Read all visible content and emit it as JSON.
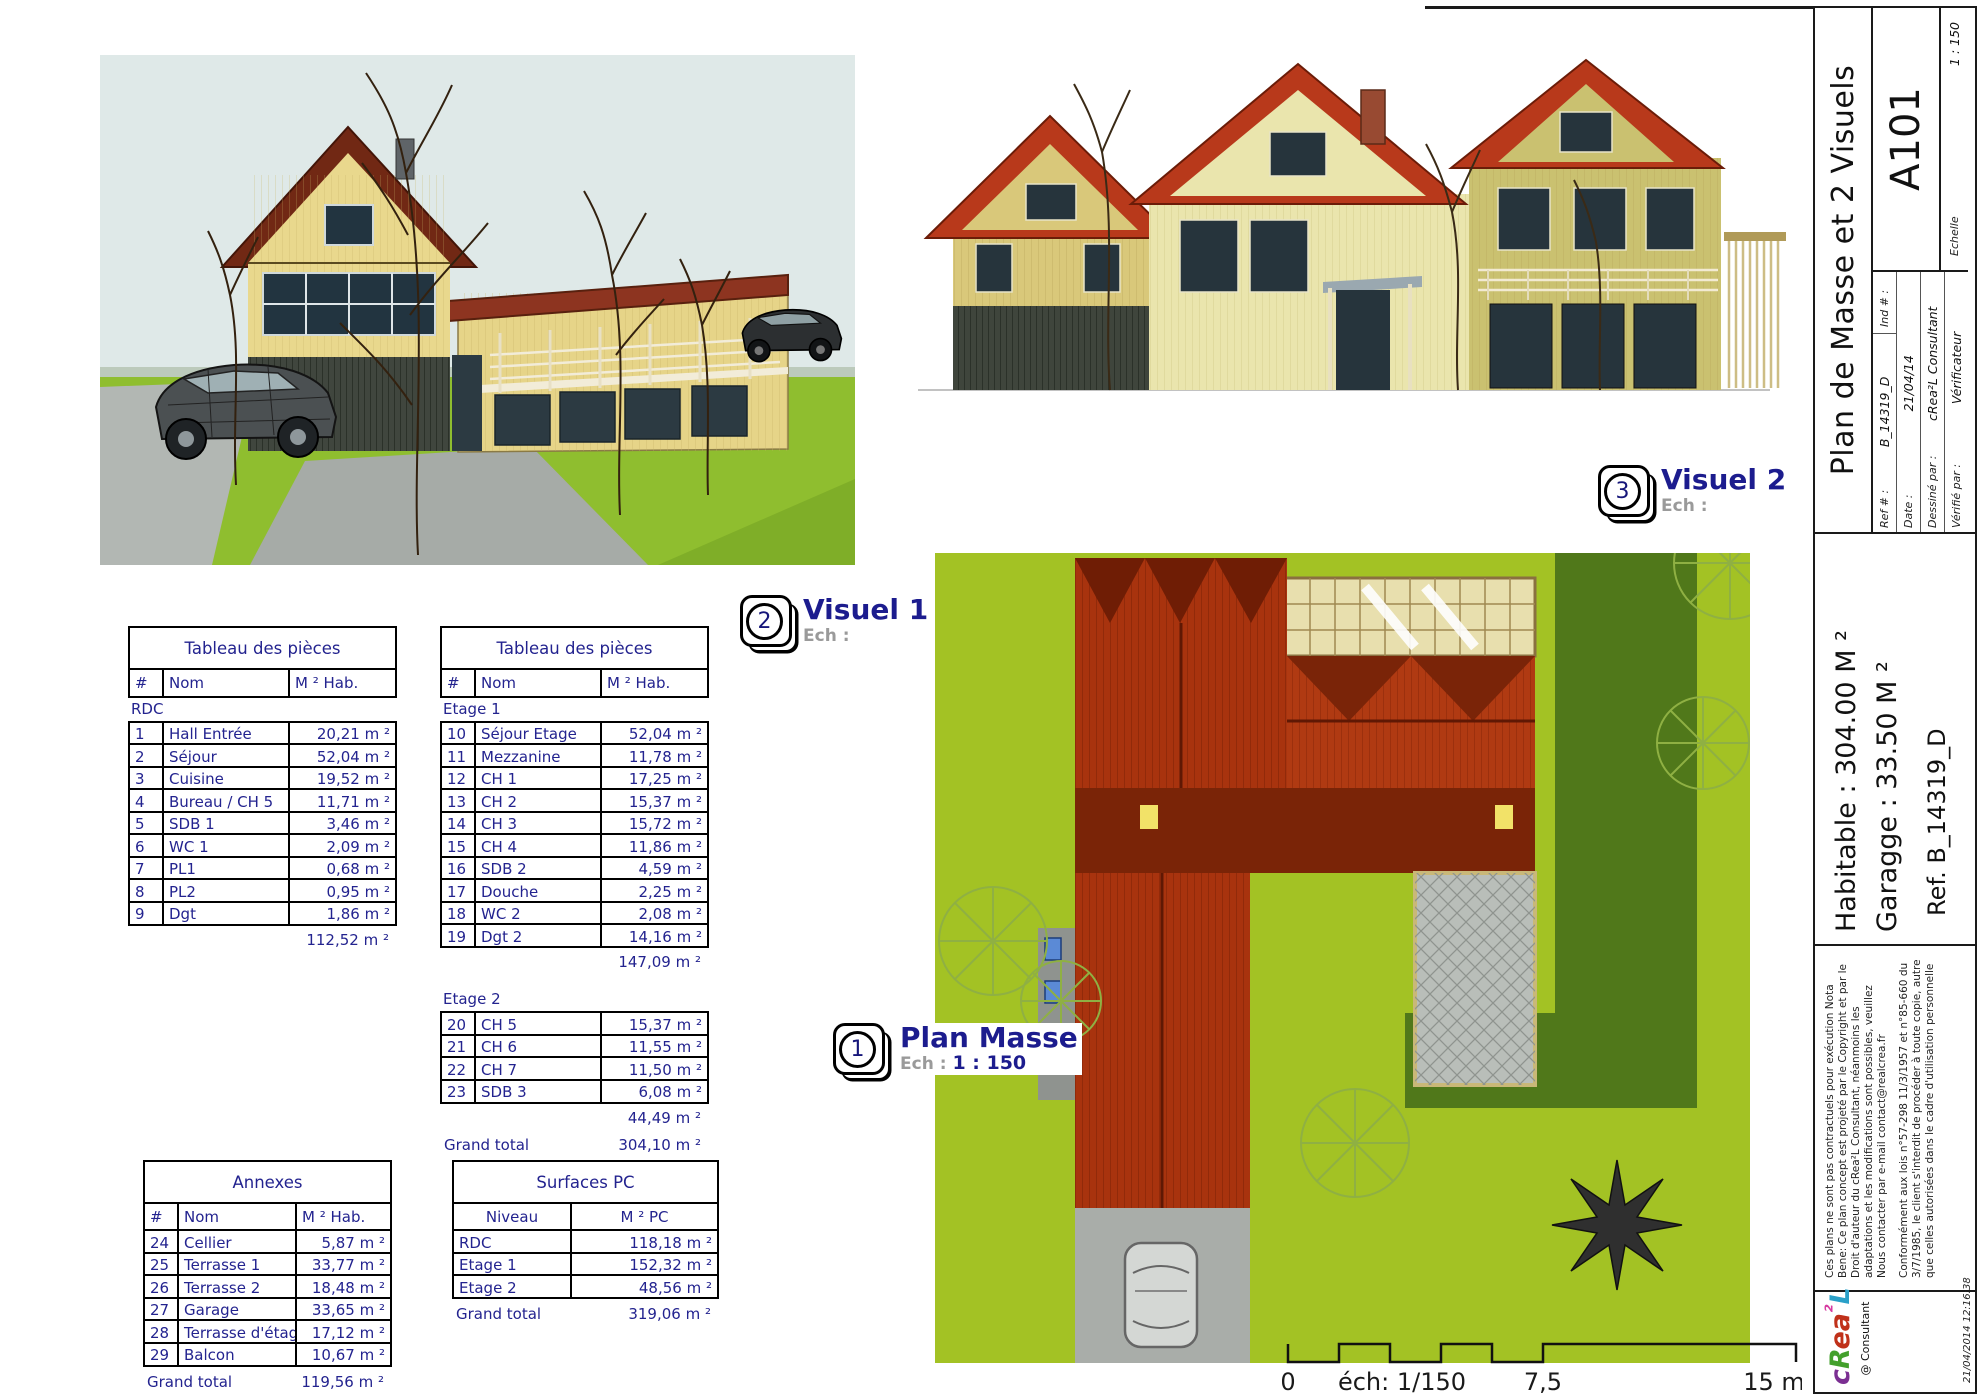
{
  "colors": {
    "table_text": "#23238f",
    "callout_label": "#1c1c8e",
    "lawn_green": "#8fbe2f",
    "site_green": "#a3c224",
    "roof_red": "#a8330e"
  },
  "titleblock": {
    "title": "Plan de Masse et 2 Visuels",
    "sheet_number": "A101",
    "ref_label": "Ref # :",
    "ref_value": "B_14319_D",
    "ind_label": "Ind # :",
    "date_label": "Date :",
    "date_value": "21/04/14",
    "drawn_label": "Dessiné par :",
    "drawn_value": "cRea²L Consultant",
    "checked_label": "Vérifié par :",
    "checked_value": "Vérificateur",
    "scale_label": "Echelle",
    "scale_value": "1 : 150",
    "habitable": "Habitable : 304.00 M ²",
    "garage": "Garagge : 33.50 M ²",
    "ref": "Ref. B_14319_D",
    "legal1": "Ces plans ne sont pas contractuels pour exécution",
    "legal2": "Nota Bene: Ce plan concept est projeté par le Copyright et par le Droit d'auteur du cRea²L Consultant, néanmoins les adaptations et les modifications sont possibles, veuillez Nous contacter par e-mail contact@realcrea.fr",
    "legal3": "Conformément aux lois n°57-298 11/3/1957 et n°85-660 du 3/7/1985, le client s'interdit de procéder à toute copie, autre que celles autorisées dans le cadre d'utilisation personnelle",
    "consultant": "@ Consultant",
    "timestamp": "21/04/2014 12:16:38",
    "logo": {
      "letters": [
        {
          "ch": "c",
          "color": "#7b2f92"
        },
        {
          "ch": "R",
          "color": "#43a02c"
        },
        {
          "ch": "e",
          "color": "#c0311a"
        },
        {
          "ch": "a",
          "color": "#c0311a"
        },
        {
          "ch": "²",
          "color": "#d63aa0"
        },
        {
          "ch": "L",
          "color": "#2aa0c8"
        }
      ]
    }
  },
  "callouts": [
    {
      "number": "2",
      "label": "Visuel 1",
      "ech_label": "Ech :",
      "scale": ""
    },
    {
      "number": "3",
      "label": "Visuel 2",
      "ech_label": "Ech :",
      "scale": ""
    },
    {
      "number": "1",
      "label": "Plan Masse",
      "ech_label": "Ech :",
      "scale": "1 : 150"
    }
  ],
  "scalebar": {
    "start": "0",
    "note": "éch: 1/150",
    "mid": "7,5",
    "end": "15 m"
  },
  "tables": {
    "pieces_rdc": {
      "title": "Tableau des pièces",
      "headers": [
        "#",
        "Nom",
        "M ² Hab."
      ],
      "groups": [
        {
          "label": "RDC",
          "rows": [
            [
              "1",
              "Hall Entrée",
              "20,21 m ²"
            ],
            [
              "2",
              "Séjour",
              "52,04 m ²"
            ],
            [
              "3",
              "Cuisine",
              "19,52 m ²"
            ],
            [
              "4",
              "Bureau / CH 5",
              "11,71 m ²"
            ],
            [
              "5",
              "SDB 1",
              "3,46 m ²"
            ],
            [
              "6",
              "WC 1",
              "2,09 m ²"
            ],
            [
              "7",
              "PL1",
              "0,68 m ²"
            ],
            [
              "8",
              "PL2",
              "0,95 m ²"
            ],
            [
              "9",
              "Dgt",
              "1,86 m ²"
            ]
          ],
          "subtotal": "112,52 m ²"
        }
      ]
    },
    "pieces_etages": {
      "title": "Tableau des pièces",
      "headers": [
        "#",
        "Nom",
        "M ² Hab."
      ],
      "groups": [
        {
          "label": "Etage 1",
          "rows": [
            [
              "10",
              "Séjour Etage",
              "52,04 m ²"
            ],
            [
              "11",
              "Mezzanine",
              "11,78 m ²"
            ],
            [
              "12",
              "CH 1",
              "17,25 m ²"
            ],
            [
              "13",
              "CH 2",
              "15,37 m ²"
            ],
            [
              "14",
              "CH 3",
              "15,72 m ²"
            ],
            [
              "15",
              "CH 4",
              "11,86 m ²"
            ],
            [
              "16",
              "SDB 2",
              "4,59 m ²"
            ],
            [
              "17",
              "Douche",
              "2,25 m ²"
            ],
            [
              "18",
              "WC 2",
              "2,08 m ²"
            ],
            [
              "19",
              "Dgt 2",
              "14,16 m ²"
            ]
          ],
          "subtotal": "147,09 m ²"
        },
        {
          "label": "Etage 2",
          "rows": [
            [
              "20",
              "CH 5",
              "15,37 m ²"
            ],
            [
              "21",
              "CH 6",
              "11,55 m ²"
            ],
            [
              "22",
              "CH 7",
              "11,50 m ²"
            ],
            [
              "23",
              "SDB 3",
              "6,08 m ²"
            ]
          ],
          "subtotal": "44,49 m ²"
        }
      ],
      "grand_total_label": "Grand total",
      "grand_total": "304,10 m ²"
    },
    "annexes": {
      "title": "Annexes",
      "headers": [
        "#",
        "Nom",
        "M ² Hab."
      ],
      "groups": [
        {
          "label": null,
          "rows": [
            [
              "24",
              "Cellier",
              "5,87 m ²"
            ],
            [
              "25",
              "Terrasse 1",
              "33,77 m ²"
            ],
            [
              "26",
              "Terrasse 2",
              "18,48 m ²"
            ],
            [
              "27",
              "Garage",
              "33,65 m ²"
            ],
            [
              "28",
              "Terrasse d'étage",
              "17,12 m ²"
            ],
            [
              "29",
              "Balcon",
              "10,67 m ²"
            ]
          ]
        }
      ],
      "grand_total_label": "Grand total",
      "grand_total": "119,56 m ²"
    },
    "surfaces_pc": {
      "title": "Surfaces PC",
      "headers": [
        "Niveau",
        "M ² PC"
      ],
      "groups": [
        {
          "label": null,
          "rows": [
            [
              "RDC",
              "118,18 m ²"
            ],
            [
              "Etage 1",
              "152,32 m ²"
            ],
            [
              "Etage 2",
              "48,56 m ²"
            ]
          ]
        }
      ],
      "grand_total_label": "Grand total",
      "grand_total": "319,06 m ²"
    }
  }
}
